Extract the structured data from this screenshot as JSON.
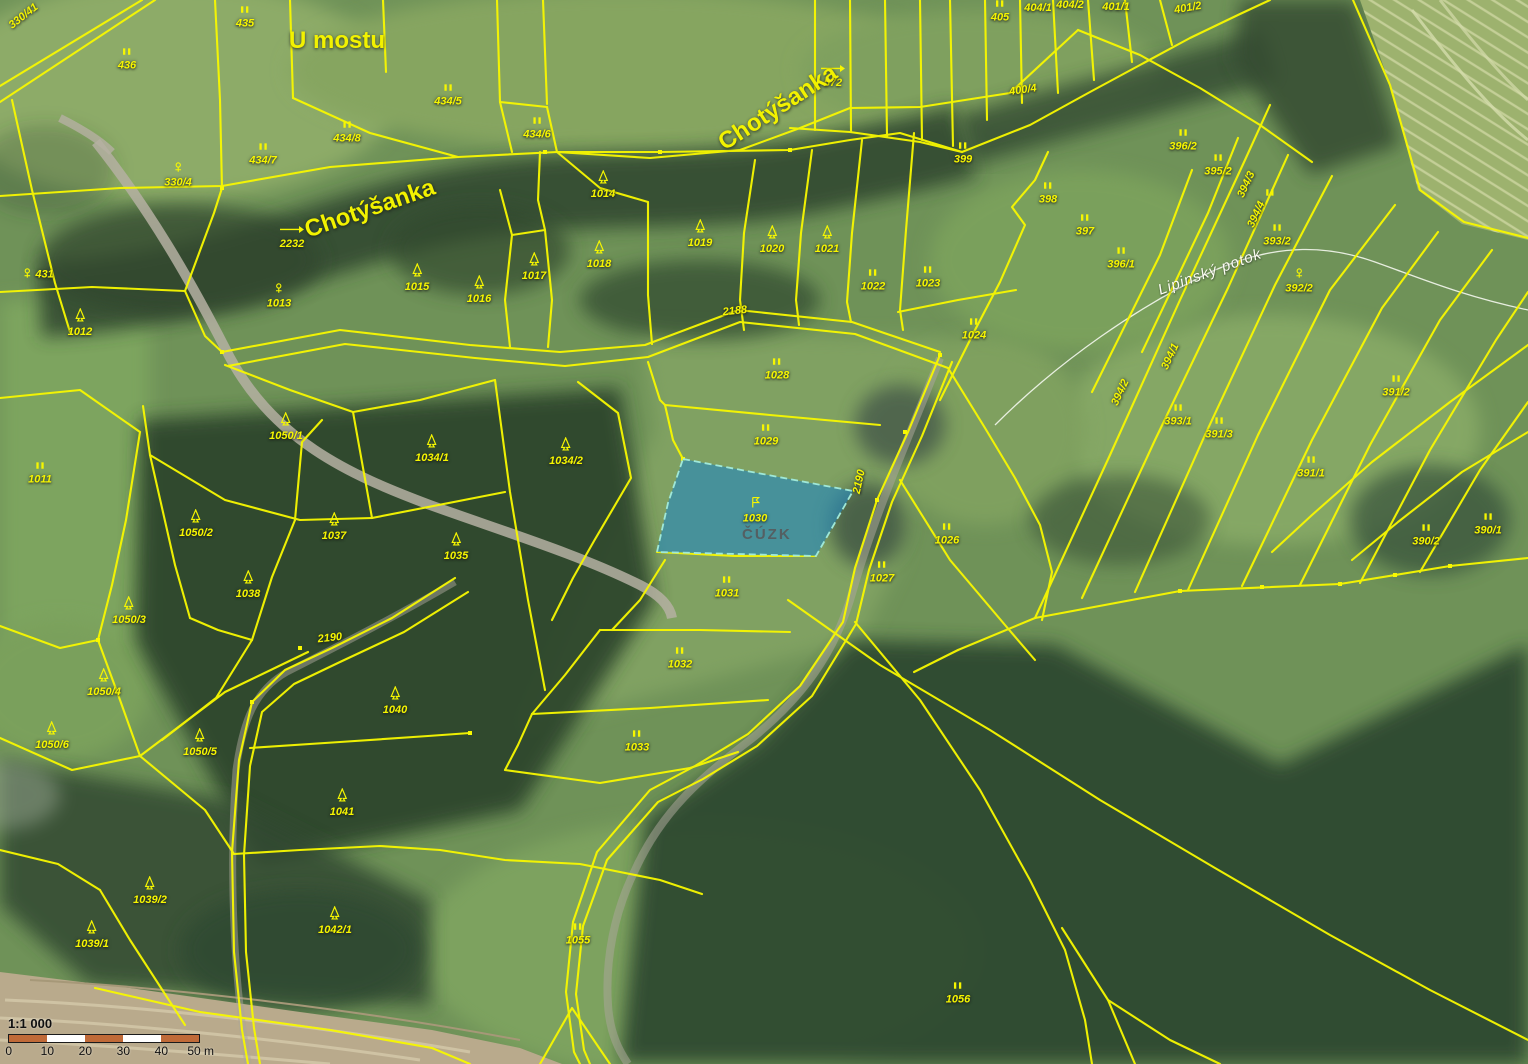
{
  "map": {
    "watermark": "ČÚZK",
    "highlight": {
      "parcel": "1030",
      "fill": "#2387bd",
      "stroke": "#9fe8d8"
    },
    "colors": {
      "boundary": "#f8f800",
      "water_label": "#fdfdf4",
      "scalebar_orange": "#c06a38"
    },
    "scalebar": {
      "ratio": "1:1 000",
      "ticks": [
        "0",
        "10",
        "20",
        "30",
        "40",
        "50 m"
      ]
    },
    "place_labels": [
      {
        "t": "U mostu",
        "x": 337,
        "y": 41,
        "cls": "big",
        "r": 0
      },
      {
        "t": "Chotýšanka",
        "x": 370,
        "y": 209,
        "cls": "big",
        "r": -19
      },
      {
        "t": "Chotýšanka",
        "x": 778,
        "y": 108,
        "cls": "big",
        "r": -33
      },
      {
        "t": "Lipinský potok",
        "x": 1210,
        "y": 272,
        "cls": "water",
        "r": -20
      }
    ],
    "parcel_labels": [
      {
        "t": "435",
        "x": 245,
        "y": 20,
        "i": "grass"
      },
      {
        "t": "436",
        "x": 127,
        "y": 62,
        "i": "grass"
      },
      {
        "t": "434/5",
        "x": 448,
        "y": 98,
        "i": "grass"
      },
      {
        "t": "434/8",
        "x": 347,
        "y": 135,
        "i": "grass"
      },
      {
        "t": "434/6",
        "x": 537,
        "y": 131,
        "i": "grass"
      },
      {
        "t": "434/7",
        "x": 263,
        "y": 157,
        "i": "grass"
      },
      {
        "t": "330/4",
        "x": 178,
        "y": 178,
        "i": "flower"
      },
      {
        "t": "330/41",
        "x": 24,
        "y": 18,
        "i": "none",
        "r": -38
      },
      {
        "t": "431",
        "x": 38,
        "y": 277,
        "i": "flower",
        "inline": true
      },
      {
        "t": "2232",
        "x": 292,
        "y": 240,
        "i": "arrow"
      },
      {
        "t": "572",
        "x": 833,
        "y": 79,
        "i": "arrow"
      },
      {
        "t": "1012",
        "x": 80,
        "y": 326,
        "i": "tree"
      },
      {
        "t": "1013",
        "x": 279,
        "y": 299,
        "i": "flower"
      },
      {
        "t": "1014",
        "x": 603,
        "y": 188,
        "i": "tree"
      },
      {
        "t": "1015",
        "x": 417,
        "y": 281,
        "i": "tree"
      },
      {
        "t": "1016",
        "x": 479,
        "y": 293,
        "i": "tree"
      },
      {
        "t": "1017",
        "x": 534,
        "y": 270,
        "i": "tree"
      },
      {
        "t": "1018",
        "x": 599,
        "y": 258,
        "i": "tree"
      },
      {
        "t": "1019",
        "x": 700,
        "y": 237,
        "i": "tree"
      },
      {
        "t": "1020",
        "x": 772,
        "y": 243,
        "i": "tree"
      },
      {
        "t": "1021",
        "x": 827,
        "y": 243,
        "i": "tree"
      },
      {
        "t": "1022",
        "x": 873,
        "y": 283,
        "i": "grass"
      },
      {
        "t": "1023",
        "x": 928,
        "y": 280,
        "i": "grass"
      },
      {
        "t": "1024",
        "x": 974,
        "y": 332,
        "i": "grass"
      },
      {
        "t": "1028",
        "x": 777,
        "y": 372,
        "i": "grass"
      },
      {
        "t": "2188",
        "x": 735,
        "y": 313,
        "i": "none",
        "r": -6
      },
      {
        "t": "399",
        "x": 963,
        "y": 156,
        "i": "grass"
      },
      {
        "t": "398",
        "x": 1048,
        "y": 196,
        "i": "grass"
      },
      {
        "t": "397",
        "x": 1085,
        "y": 228,
        "i": "grass"
      },
      {
        "t": "396/1",
        "x": 1121,
        "y": 261,
        "i": "grass"
      },
      {
        "t": "396/2",
        "x": 1183,
        "y": 143,
        "i": "grass"
      },
      {
        "t": "395/2",
        "x": 1218,
        "y": 168,
        "i": "grass"
      },
      {
        "t": "405",
        "x": 1000,
        "y": 14,
        "i": "grass"
      },
      {
        "t": "404/1",
        "x": 1038,
        "y": 10,
        "i": "none"
      },
      {
        "t": "404/2",
        "x": 1070,
        "y": 7,
        "i": "none"
      },
      {
        "t": "401/1",
        "x": 1116,
        "y": 9,
        "i": "none"
      },
      {
        "t": "401/2",
        "x": 1188,
        "y": 10,
        "i": "none",
        "r": -10
      },
      {
        "t": "400/4",
        "x": 1023,
        "y": 92,
        "i": "none",
        "r": -8
      },
      {
        "t": "394/3",
        "x": 1247,
        "y": 186,
        "i": "none",
        "r": -65
      },
      {
        "t": "394/4",
        "x": 1257,
        "y": 216,
        "i": "none",
        "r": -65
      },
      {
        "t": "",
        "x": 1270,
        "y": 196,
        "i": "grass"
      },
      {
        "t": "393/2",
        "x": 1277,
        "y": 238,
        "i": "grass"
      },
      {
        "t": "392/2",
        "x": 1299,
        "y": 284,
        "i": "flower"
      },
      {
        "t": "391/2",
        "x": 1396,
        "y": 389,
        "i": "grass"
      },
      {
        "t": "394/1",
        "x": 1171,
        "y": 358,
        "i": "none",
        "r": -65
      },
      {
        "t": "394/2",
        "x": 1121,
        "y": 394,
        "i": "none",
        "r": -65
      },
      {
        "t": "393/1",
        "x": 1178,
        "y": 418,
        "i": "grass"
      },
      {
        "t": "391/3",
        "x": 1219,
        "y": 431,
        "i": "grass"
      },
      {
        "t": "391/1",
        "x": 1311,
        "y": 470,
        "i": "grass"
      },
      {
        "t": "390/2",
        "x": 1426,
        "y": 538,
        "i": "grass"
      },
      {
        "t": "390/1",
        "x": 1488,
        "y": 527,
        "i": "grass"
      },
      {
        "t": "1011",
        "x": 40,
        "y": 476,
        "i": "grass"
      },
      {
        "t": "1050/1",
        "x": 286,
        "y": 430,
        "i": "tree"
      },
      {
        "t": "1034/1",
        "x": 432,
        "y": 452,
        "i": "tree"
      },
      {
        "t": "1034/2",
        "x": 566,
        "y": 455,
        "i": "tree"
      },
      {
        "t": "1050/2",
        "x": 196,
        "y": 527,
        "i": "tree"
      },
      {
        "t": "1037",
        "x": 334,
        "y": 530,
        "i": "tree"
      },
      {
        "t": "1035",
        "x": 456,
        "y": 550,
        "i": "tree"
      },
      {
        "t": "1038",
        "x": 248,
        "y": 588,
        "i": "tree"
      },
      {
        "t": "1050/3",
        "x": 129,
        "y": 614,
        "i": "tree"
      },
      {
        "t": "1029",
        "x": 766,
        "y": 438,
        "i": "grass"
      },
      {
        "t": "1030",
        "x": 755,
        "y": 513,
        "i": "flag"
      },
      {
        "t": "1026",
        "x": 947,
        "y": 537,
        "i": "grass"
      },
      {
        "t": "1027",
        "x": 882,
        "y": 575,
        "i": "grass"
      },
      {
        "t": "2190",
        "x": 860,
        "y": 483,
        "i": "none",
        "r": -78
      },
      {
        "t": "1031",
        "x": 727,
        "y": 590,
        "i": "grass"
      },
      {
        "t": "1050/4",
        "x": 104,
        "y": 686,
        "i": "tree"
      },
      {
        "t": "1050/6",
        "x": 52,
        "y": 739,
        "i": "tree"
      },
      {
        "t": "1050/5",
        "x": 200,
        "y": 746,
        "i": "tree"
      },
      {
        "t": "2190",
        "x": 330,
        "y": 640,
        "i": "none",
        "r": -6
      },
      {
        "t": "1040",
        "x": 395,
        "y": 704,
        "i": "tree"
      },
      {
        "t": "1041",
        "x": 342,
        "y": 806,
        "i": "tree"
      },
      {
        "t": "1032",
        "x": 680,
        "y": 661,
        "i": "grass"
      },
      {
        "t": "1033",
        "x": 637,
        "y": 744,
        "i": "grass"
      },
      {
        "t": "1039/2",
        "x": 150,
        "y": 894,
        "i": "tree"
      },
      {
        "t": "1039/1",
        "x": 92,
        "y": 938,
        "i": "tree"
      },
      {
        "t": "1042/1",
        "x": 335,
        "y": 924,
        "i": "tree"
      },
      {
        "t": "1055",
        "x": 578,
        "y": 937,
        "i": "grass"
      },
      {
        "t": "1056",
        "x": 958,
        "y": 996,
        "i": "grass"
      }
    ]
  }
}
